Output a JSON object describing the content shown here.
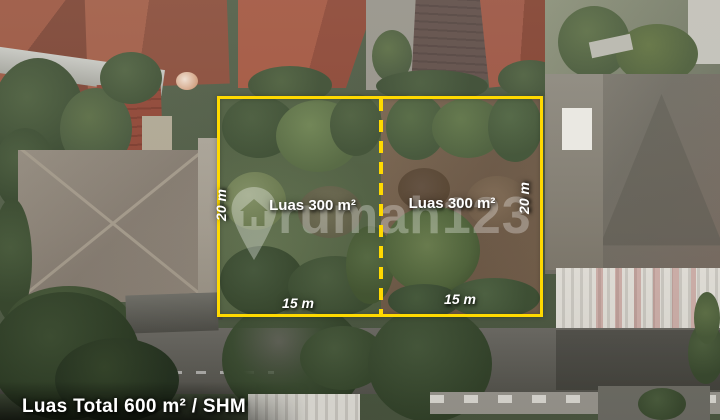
{
  "overlay": {
    "boundary_color": "#FFD900",
    "label_color": "#FFFFFF",
    "plots": [
      {
        "area_label": "Luas 300 m²",
        "depth_label": "20 m",
        "width_label": "15 m"
      },
      {
        "area_label": "Luas 300 m²",
        "depth_label": "20 m",
        "width_label": "15 m"
      }
    ],
    "total_label": "Luas Total 600 m² / SHM"
  },
  "watermark": {
    "brand": "rumah123",
    "icon": "rumah123-pin-icon"
  }
}
